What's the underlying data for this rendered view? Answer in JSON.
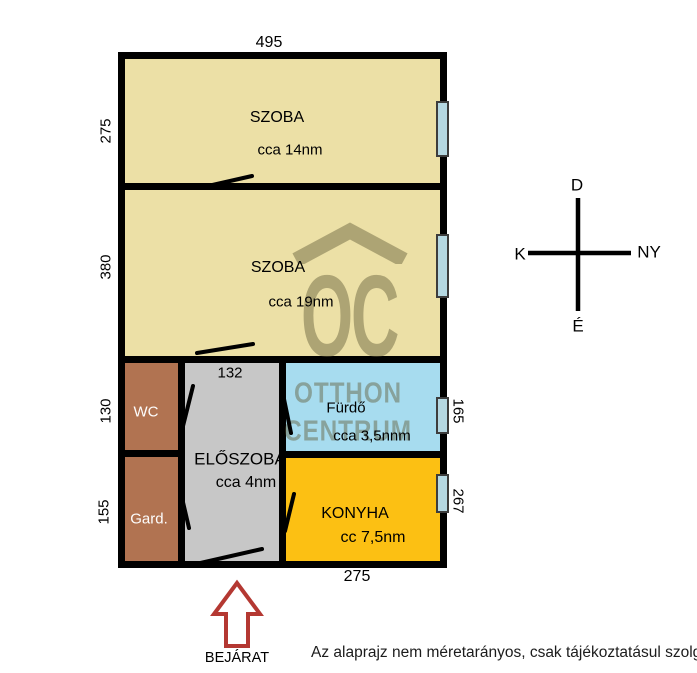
{
  "title_none": "",
  "rooms": {
    "szoba1": {
      "name": "SZOBA",
      "area": "cca 14nm"
    },
    "szoba2": {
      "name": "SZOBA",
      "area": "cca 19nm"
    },
    "wc": {
      "name": "WC"
    },
    "gard": {
      "name": "Gard."
    },
    "eloszoba": {
      "name": "ELŐSZOBA",
      "area": "cca 4nm"
    },
    "furdo": {
      "name": "Fürdő",
      "area": "cca 3,5nnm"
    },
    "konyha": {
      "name": "KONYHA",
      "area": "cc 7,5nm"
    }
  },
  "dimensions": {
    "top_width": "495",
    "szoba1_height": "275",
    "szoba2_height": "380",
    "wc_height": "130",
    "gard_height": "155",
    "eloszoba_width": "132",
    "furdo_height": "165",
    "konyha_height": "267",
    "bottom_width": "275"
  },
  "compass": {
    "up": "D",
    "left": "K",
    "right": "NY",
    "down": "É"
  },
  "entrance": {
    "label": "BEJÁRAT"
  },
  "watermark": {
    "logo": "OC",
    "line1": "OTTHON",
    "line2": "CENTRUM"
  },
  "disclaimer": "Az alaprajz nem méretarányos, csak tájékoztatásul szolgál.",
  "colors": {
    "room_tan": "#ECE0A6",
    "room_brown": "#B17351",
    "room_gray": "#C7C7C7",
    "room_blue": "#A7DCEF",
    "room_yellow": "#FCC013",
    "wall": "#000000",
    "window_fill": "#B5D8E2",
    "arrow_red": "#B43832",
    "watermark_olive": "rgba(97,91,56,0.45)"
  }
}
